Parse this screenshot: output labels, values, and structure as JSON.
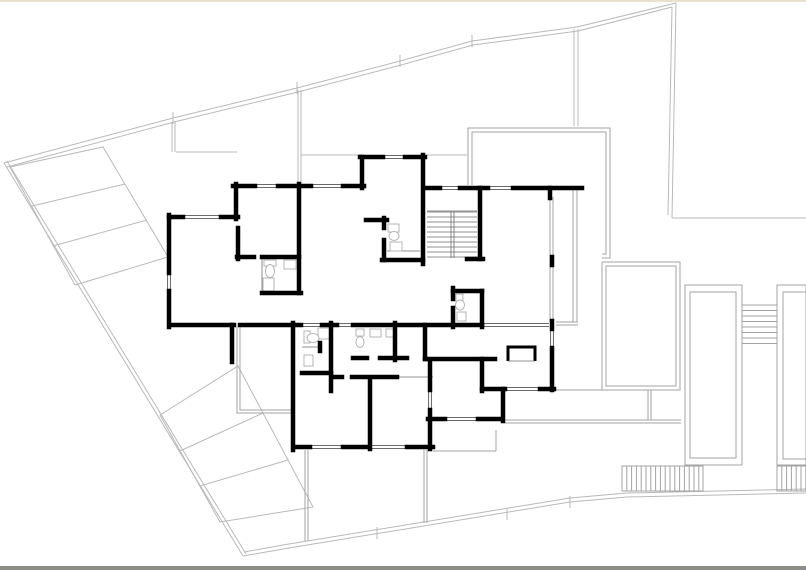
{
  "meta": {
    "drawing_type": "architectural-floor-plan",
    "canvas": {
      "w": 806,
      "h": 570
    },
    "colors": {
      "bg": "#ffffff",
      "wall": "#000000",
      "site": "#b9b9b9",
      "terrace": "#a3a3a3",
      "thin": "#6e6e6e",
      "fixture": "#b5b5b5",
      "top_strip": "#e9e1cd",
      "bottom_strip": "#8e8e86"
    }
  },
  "site": {
    "outer_top": [
      [
        4,
        163
      ],
      [
        173,
        118
      ],
      [
        297,
        88
      ],
      [
        400,
        61
      ],
      [
        472,
        41
      ],
      [
        577,
        27
      ],
      [
        676,
        3
      ]
    ],
    "inner_top": [
      [
        7,
        167
      ],
      [
        174,
        122
      ],
      [
        298,
        92
      ],
      [
        401,
        65
      ],
      [
        473,
        45
      ],
      [
        578,
        31
      ],
      [
        672,
        7
      ]
    ],
    "outer_left": [
      [
        4,
        163
      ],
      [
        243,
        556
      ]
    ],
    "inner_left": [
      [
        7,
        161
      ],
      [
        246,
        554
      ]
    ],
    "outer_right": [
      [
        676,
        3
      ],
      [
        672,
        218
      ]
    ],
    "inner_right": [
      [
        672,
        7
      ],
      [
        668,
        215
      ]
    ],
    "h_right": [
      [
        672,
        218
      ],
      [
        806,
        218
      ]
    ],
    "outer_bottom": [
      [
        243,
        556
      ],
      [
        283,
        549
      ],
      [
        570,
        502
      ],
      [
        627,
        497
      ],
      [
        806,
        493
      ]
    ],
    "inner_bottom": [
      [
        244,
        552
      ],
      [
        283,
        545
      ],
      [
        570,
        498
      ],
      [
        627,
        493
      ],
      [
        806,
        489
      ]
    ],
    "ticks": [
      [
        173,
        112,
        173,
        124
      ],
      [
        297,
        82,
        297,
        94
      ],
      [
        400,
        55,
        400,
        67
      ],
      [
        472,
        35,
        472,
        47
      ],
      [
        377,
        527,
        377,
        539
      ],
      [
        507,
        508,
        507,
        520
      ],
      [
        570,
        496,
        570,
        508
      ]
    ],
    "division_pairs": [
      [
        574,
        29,
        574,
        126
      ],
      [
        578,
        29,
        578,
        126
      ],
      [
        172,
        122,
        172,
        152
      ],
      [
        175,
        122,
        175,
        152
      ],
      [
        298,
        90,
        298,
        184
      ],
      [
        301,
        90,
        301,
        184
      ]
    ],
    "misc_lines": [
      [
        176,
        152,
        237,
        152
      ],
      [
        301,
        155,
        362,
        155
      ],
      [
        427,
        155,
        467,
        155
      ]
    ]
  },
  "parking": [
    {
      "outline": [
        [
          10,
          167
        ],
        [
          103,
          147
        ],
        [
          168,
          257
        ],
        [
          75,
          285
        ]
      ],
      "dividers": [
        [
          32,
          206,
          125,
          184
        ],
        [
          53,
          246,
          147,
          220
        ]
      ]
    },
    {
      "outline": [
        [
          160,
          415
        ],
        [
          238,
          366
        ],
        [
          313,
          507
        ],
        [
          220,
          522
        ]
      ],
      "dividers": [
        [
          180,
          451,
          263,
          413
        ],
        [
          200,
          486,
          288,
          460
        ]
      ]
    }
  ],
  "terraces": {
    "polylines": [
      [
        [
          468,
          185
        ],
        [
          468,
          128
        ],
        [
          610,
          128
        ],
        [
          610,
          258
        ],
        [
          602,
          258
        ]
      ],
      [
        [
          472,
          185
        ],
        [
          472,
          132
        ],
        [
          606,
          132
        ],
        [
          606,
          254
        ],
        [
          602,
          254
        ]
      ],
      [
        [
          602,
          262
        ],
        [
          680,
          262
        ],
        [
          680,
          390
        ],
        [
          602,
          390
        ],
        [
          602,
          262
        ]
      ],
      [
        [
          606,
          266
        ],
        [
          676,
          266
        ],
        [
          676,
          386
        ],
        [
          606,
          386
        ],
        [
          606,
          266
        ]
      ],
      [
        [
          237,
          327
        ],
        [
          237,
          413
        ],
        [
          293,
          413
        ]
      ],
      [
        [
          240,
          327
        ],
        [
          240,
          410
        ],
        [
          293,
          410
        ]
      ]
    ],
    "lines": [
      [
        550,
        197,
        550,
        322
      ],
      [
        553,
        197,
        553,
        322
      ],
      [
        573,
        190,
        573,
        322
      ],
      [
        577,
        190,
        577,
        322
      ],
      [
        556,
        322,
        578,
        322
      ],
      [
        556,
        325,
        578,
        325
      ],
      [
        305,
        450,
        305,
        541
      ],
      [
        308,
        450,
        308,
        541
      ],
      [
        424,
        450,
        424,
        523
      ],
      [
        427,
        450,
        427,
        523
      ],
      [
        433,
        451,
        496,
        451
      ],
      [
        496,
        430,
        496,
        451
      ],
      [
        556,
        390,
        648,
        390
      ],
      [
        648,
        390,
        648,
        420
      ],
      [
        651,
        390,
        651,
        420
      ],
      [
        505,
        420,
        681,
        420
      ],
      [
        505,
        423,
        681,
        423
      ]
    ]
  },
  "pools": [
    {
      "outer": [
        685,
        285,
        57,
        180
      ],
      "inner": [
        690,
        292,
        46,
        166
      ]
    },
    {
      "outer": [
        777,
        285,
        29,
        180
      ],
      "inner": [
        783,
        292,
        23,
        167
      ]
    }
  ],
  "exterior_stairs": {
    "x1": 742,
    "x2": 777,
    "ys": [
      305,
      310.5,
      316,
      321.5,
      327,
      332.5,
      338,
      343.5
    ]
  },
  "hatch_strips": [
    {
      "x": 622,
      "y": 466,
      "w": 81,
      "h": 25,
      "step": 4.8
    },
    {
      "x": 777,
      "y": 466,
      "w": 29,
      "h": 25,
      "step": 4.8
    }
  ],
  "walls": [
    [
      233,
      186,
      255,
      186
    ],
    [
      278,
      186,
      311,
      186
    ],
    [
      343,
      186,
      364,
      186
    ],
    [
      362,
      157,
      362,
      188
    ],
    [
      360,
      157,
      383,
      157
    ],
    [
      405,
      157,
      425,
      157
    ],
    [
      423,
      155,
      423,
      264
    ],
    [
      427,
      188,
      440,
      188
    ],
    [
      460,
      188,
      488,
      188
    ],
    [
      513,
      188,
      582,
      188
    ],
    [
      550,
      188,
      550,
      198
    ],
    [
      236,
      184,
      236,
      219
    ],
    [
      169,
      217,
      183,
      217
    ],
    [
      221,
      217,
      238,
      217
    ],
    [
      169,
      215,
      169,
      273
    ],
    [
      169,
      291,
      169,
      327
    ],
    [
      237,
      257,
      254,
      257
    ],
    [
      262,
      257,
      299,
      257
    ],
    [
      238,
      228,
      238,
      259
    ],
    [
      299,
      184,
      299,
      293
    ],
    [
      262,
      293,
      301,
      293
    ],
    [
      171,
      325,
      234,
      325
    ],
    [
      240,
      325,
      301,
      325
    ],
    [
      322,
      325,
      337,
      325
    ],
    [
      353,
      325,
      482,
      325
    ],
    [
      552,
      321,
      552,
      329
    ],
    [
      552,
      257,
      552,
      265
    ],
    [
      293,
      323,
      293,
      450
    ],
    [
      331,
      323,
      331,
      391
    ],
    [
      302,
      373,
      331,
      373
    ],
    [
      333,
      377,
      342,
      377
    ],
    [
      352,
      377,
      397,
      377
    ],
    [
      370,
      379,
      370,
      449
    ],
    [
      395,
      323,
      395,
      360
    ],
    [
      353,
      358,
      367,
      358
    ],
    [
      380,
      358,
      407,
      358
    ],
    [
      425,
      325,
      425,
      359
    ],
    [
      425,
      359,
      495,
      359
    ],
    [
      482,
      359,
      482,
      391
    ],
    [
      482,
      389,
      505,
      389
    ],
    [
      503,
      389,
      503,
      421
    ],
    [
      428,
      419,
      445,
      419
    ],
    [
      478,
      419,
      500,
      419
    ],
    [
      430,
      361,
      430,
      390
    ],
    [
      430,
      410,
      430,
      449
    ],
    [
      296,
      447,
      310,
      447
    ],
    [
      343,
      447,
      367,
      447
    ],
    [
      407,
      447,
      433,
      447
    ],
    [
      552,
      348,
      552,
      390
    ],
    [
      540,
      389,
      554,
      389
    ],
    [
      453,
      288,
      453,
      299
    ],
    [
      453,
      308,
      453,
      327
    ],
    [
      453,
      291,
      482,
      291
    ],
    [
      482,
      291,
      482,
      327
    ],
    [
      480,
      188,
      480,
      259
    ],
    [
      467,
      259,
      483,
      259
    ],
    [
      382,
      260,
      423,
      260
    ],
    [
      384,
      218,
      384,
      228
    ],
    [
      384,
      240,
      384,
      260
    ],
    [
      366,
      220,
      387,
      220
    ],
    [
      232,
      325,
      232,
      362
    ],
    [
      320,
      343,
      320,
      351
    ]
  ],
  "kitchen_counter": {
    "u": [
      [
        508,
        361
      ],
      [
        508,
        347
      ],
      [
        535,
        347
      ],
      [
        535,
        361
      ]
    ],
    "bottom": [
      508,
      361,
      535,
      361
    ]
  },
  "windows": [
    [
      255,
      186,
      278,
      186
    ],
    [
      311,
      186,
      343,
      186
    ],
    [
      383,
      157,
      405,
      157
    ],
    [
      440,
      188,
      460,
      188
    ],
    [
      488,
      188,
      513,
      188
    ],
    [
      183,
      217,
      221,
      217
    ],
    [
      169,
      273,
      169,
      291
    ],
    [
      301,
      325,
      322,
      325
    ],
    [
      337,
      325,
      353,
      325
    ],
    [
      482,
      325,
      549,
      325
    ],
    [
      310,
      447,
      343,
      447
    ],
    [
      367,
      447,
      407,
      447
    ],
    [
      430,
      390,
      430,
      410
    ],
    [
      505,
      389,
      540,
      389
    ],
    [
      552,
      329,
      552,
      347
    ],
    [
      445,
      419,
      478,
      419
    ]
  ],
  "thin_lines": [
    [
      397,
      377,
      433,
      377
    ],
    [
      302,
      347,
      320,
      347
    ],
    [
      262,
      259,
      262,
      291
    ],
    [
      387,
      251,
      420,
      251
    ],
    [
      427,
      211,
      477,
      211
    ],
    [
      451,
      212,
      451,
      258
    ],
    [
      454,
      212,
      454,
      258
    ]
  ],
  "interior_stairs": {
    "x1": 427,
    "x2": 477,
    "ys": [
      212,
      217,
      222,
      227,
      232,
      237,
      242,
      247,
      252,
      257
    ]
  },
  "fixtures": {
    "rects": [
      [
        264,
        260,
        12,
        6
      ],
      [
        284,
        260,
        12,
        9
      ],
      [
        263,
        278,
        11,
        13
      ],
      [
        304,
        331,
        6,
        12
      ],
      [
        318,
        328,
        12,
        11
      ],
      [
        304,
        355,
        9,
        11
      ],
      [
        356,
        329,
        8,
        7
      ],
      [
        370,
        329,
        11,
        8
      ],
      [
        386,
        329,
        9,
        8
      ],
      [
        456,
        294,
        7,
        11
      ],
      [
        457,
        312,
        9,
        9
      ],
      [
        388,
        224,
        11,
        8
      ],
      [
        390,
        242,
        12,
        9
      ]
    ],
    "ellipses": [
      [
        270,
        271,
        4.5,
        6.5
      ],
      [
        313,
        338,
        6,
        4.5
      ],
      [
        360,
        342,
        4,
        5.5
      ],
      [
        460,
        305,
        4.5,
        5
      ],
      [
        394,
        236,
        5,
        4.5
      ]
    ]
  }
}
